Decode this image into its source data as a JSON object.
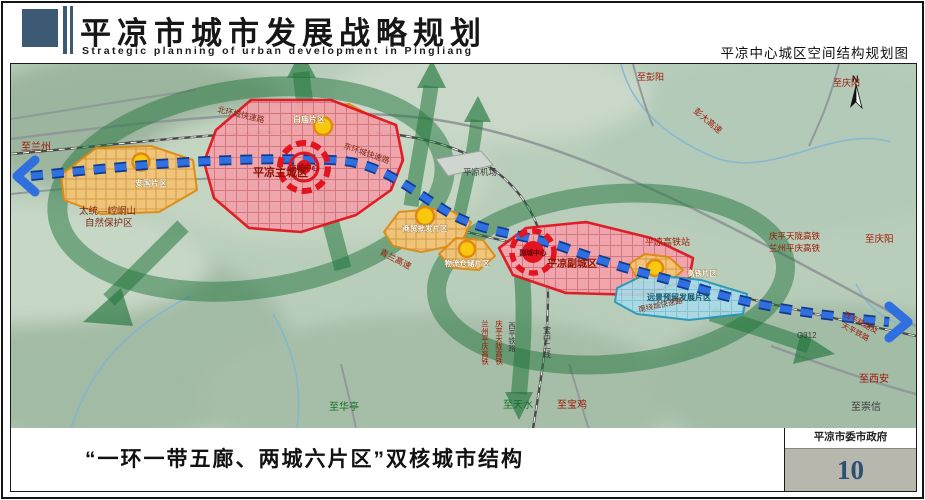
{
  "header": {
    "title_cn": "平凉市城市发展战略规划",
    "title_en": "Strategic planning of urban development in Pingliang",
    "subtitle_right": "平凉中心城区空间结构规划图"
  },
  "footer": {
    "caption": "“一环一带五廊、两城六片区”双核城市结构",
    "agency": "平凉市委市政府",
    "page_number": "10"
  },
  "map": {
    "compass": "N",
    "zones": {
      "main_city": "平凉主城区",
      "main_center": "主城中心",
      "sub_city": "平凉副城区",
      "sub_center": "副城中心",
      "anguo": "安国片区",
      "baimiao": "白庙片区",
      "shangmao": "商贸批发片区",
      "wuliu": "物流仓储片区",
      "gaotie_zone": "高铁片区",
      "reserve": "远景预留发展片区",
      "airport": "平凉机场"
    },
    "labels": {
      "to_lanzhou": "至兰州",
      "taitong_1": "太统—崆峒山",
      "taitong_2": "自然保护区",
      "north_ring_rd": "北环城快速路",
      "east_ring_rd": "东环城快速路",
      "south_ring_rd": "南绕城快速路",
      "qinglan_expwy": "青兰高速",
      "pengda_expwy": "彭大高速",
      "hsr_station": "平凉高铁站",
      "qingping_hsr": "庆平天陇高铁",
      "lanzhou_hsr": "兰州平庆高铁",
      "to_qingyang_top": "至彭阳",
      "to_qingyang_ne": "至庆阳",
      "to_qingyang_e": "至庆阳",
      "g312": "G312",
      "xiping_rail_and": "西平铁路及",
      "tianping_rail": "天平铁路",
      "to_xian": "至西安",
      "to_chongxin": "至崇信",
      "to_huating": "至华亭",
      "to_tianshui": "至天水",
      "to_baoji": "至宝鸡",
      "v_lanzhou_hsr": "兰州平庆高铁",
      "v_qingping_hsr": "庆平天陇高铁",
      "v_xiping_rail": "西平铁路",
      "v_baozhong_rail": "宝中二线"
    },
    "colors": {
      "accent_slate": "#3d5a74",
      "zone_red_border": "#e31420",
      "zone_red_fill": "#f2a3ab",
      "zone_orange_border": "#e08a10",
      "zone_orange_fill": "#f3c577",
      "zone_cyan_border": "#1f96b8",
      "zone_cyan_fill": "#aadbe8",
      "belt_blue": "#2563d4",
      "corridor_green": "#23763d",
      "terrain_green": "#b9cdbb",
      "page_number_blue": "#2d4f74",
      "stamp_gray": "#b7b7ae"
    }
  }
}
